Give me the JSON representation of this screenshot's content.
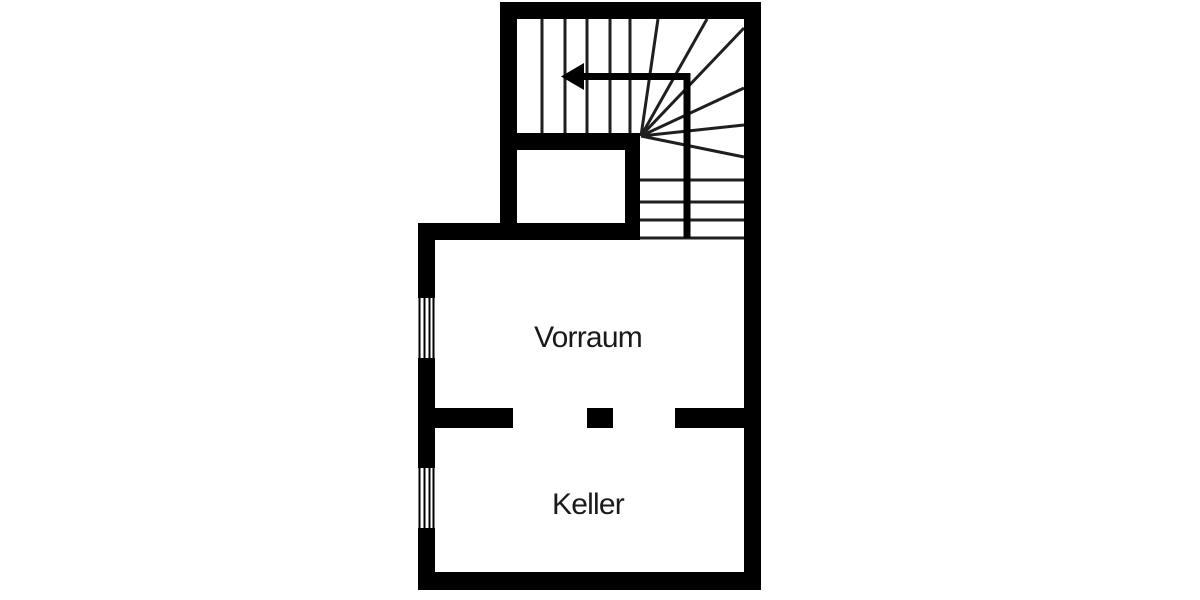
{
  "floorplan": {
    "rooms": [
      {
        "id": "vorraum",
        "label": "Vorraum"
      },
      {
        "id": "keller",
        "label": "Keller"
      }
    ],
    "staircase": {
      "type": "winder-staircase",
      "direction_arrow": "up-then-left"
    },
    "window_count": 2,
    "door_opening_count": 2,
    "colors": {
      "wall": "#000000",
      "stair_line": "#1f1f1f",
      "label_text": "#1a1a1a",
      "background": "#ffffff"
    }
  }
}
